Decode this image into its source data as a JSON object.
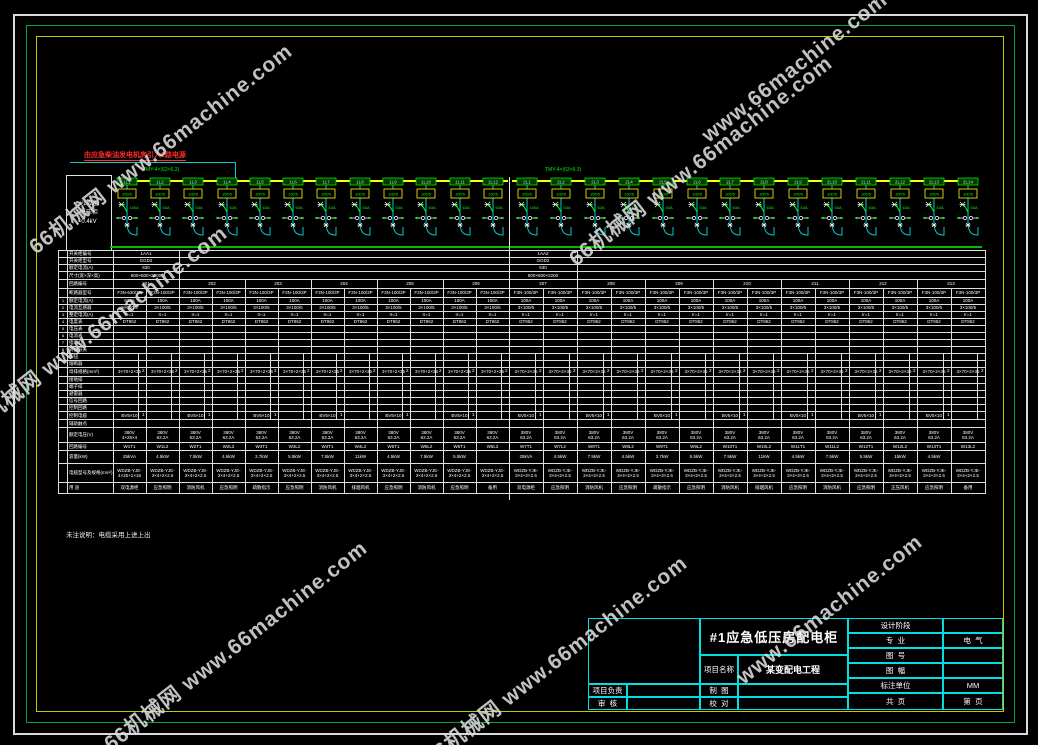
{
  "colors": {
    "frame_white": "#d9d9d9",
    "frame_green": "#00a53c",
    "frame_yellow": "#c8c800",
    "bus_yellow": "#ffff00",
    "cad_green": "#00ff00",
    "cad_cyan": "#00cccc",
    "grid_white": "#dedede",
    "note_red": "#ff2a2a",
    "titleblock_cyan": "#00e0e0"
  },
  "watermarks": {
    "texts": {
      "full": "66机械网 www.66machine.com",
      "latin": "www.66machine.com"
    },
    "items": [
      {
        "x": 160,
        "y": 148,
        "t": "full"
      },
      {
        "x": 795,
        "y": 68,
        "t": "latin"
      },
      {
        "x": 700,
        "y": 160,
        "t": "full"
      },
      {
        "x": 95,
        "y": 330,
        "t": "full"
      },
      {
        "x": 235,
        "y": 645,
        "t": "full"
      },
      {
        "x": 555,
        "y": 660,
        "t": "full"
      },
      {
        "x": 830,
        "y": 610,
        "t": "latin"
      }
    ]
  },
  "notes": {
    "incoming": "由应急柴油发电机房引入2路电源",
    "bus_spec_left": "TMY-4×(63×6.3)",
    "bus_spec_right": "TMY-4×(63×6.3)",
    "bottom": "未注说明：电缆采用上进上出"
  },
  "diagram": {
    "info": [
      "#1应急",
      "低压柜",
      "0.4kV"
    ],
    "feeders": [
      {
        "id": "1L1",
        "ct": "200/5",
        "amp": "100A"
      },
      {
        "id": "1L2",
        "ct": "100/5",
        "amp": "63A"
      },
      {
        "id": "1L3",
        "ct": "100/5",
        "amp": "63A"
      },
      {
        "id": "1L4",
        "ct": "100/5",
        "amp": "63A"
      },
      {
        "id": "1L5",
        "ct": "100/5",
        "amp": "63A"
      },
      {
        "id": "1L6",
        "ct": "100/5",
        "amp": "63A"
      },
      {
        "id": "1L7",
        "ct": "100/5",
        "amp": "63A"
      },
      {
        "id": "1L8",
        "ct": "100/5",
        "amp": "63A"
      },
      {
        "id": "1L9",
        "ct": "100/5",
        "amp": "63A"
      },
      {
        "id": "1L10",
        "ct": "100/5",
        "amp": "63A"
      },
      {
        "id": "1L11",
        "ct": "100/5",
        "amp": "63A"
      },
      {
        "id": "1L12",
        "ct": "100/5",
        "amp": "63A"
      },
      {
        "id": "2L1",
        "ct": "200/5",
        "amp": "100A"
      },
      {
        "id": "2L2",
        "ct": "100/5",
        "amp": "63A"
      },
      {
        "id": "2L3",
        "ct": "100/5",
        "amp": "63A"
      },
      {
        "id": "2L4",
        "ct": "100/5",
        "amp": "63A"
      },
      {
        "id": "2L5",
        "ct": "100/5",
        "amp": "63A"
      },
      {
        "id": "2L6",
        "ct": "100/5",
        "amp": "63A"
      },
      {
        "id": "2L7",
        "ct": "100/5",
        "amp": "63A"
      },
      {
        "id": "2L8",
        "ct": "100/5",
        "amp": "63A"
      },
      {
        "id": "2L9",
        "ct": "100/5",
        "amp": "63A"
      },
      {
        "id": "2L10",
        "ct": "100/5",
        "amp": "63A"
      },
      {
        "id": "2L11",
        "ct": "100/5",
        "amp": "63A"
      },
      {
        "id": "2L12",
        "ct": "100/5",
        "amp": "63A"
      },
      {
        "id": "2L13",
        "ct": "100/5",
        "amp": "63A"
      },
      {
        "id": "2L14",
        "ct": "100/5",
        "amp": "63A"
      }
    ]
  },
  "table": {
    "rows": [
      {
        "h": 7,
        "label": "开关柜编号",
        "type": "half",
        "l": "1AA1",
        "r": "1AA2"
      },
      {
        "h": 7,
        "label": "开关柜型号",
        "type": "half",
        "l": "GGD2",
        "r": "GGD2"
      },
      {
        "h": 7,
        "label": "额定电流(A)",
        "type": "half",
        "l": "630",
        "r": "630"
      },
      {
        "h": 8,
        "label": "尺寸(宽×深×高)",
        "type": "half",
        "l": "800×600×2200",
        "r": "800×600×2200"
      },
      {
        "h": 9,
        "label": "回路编号",
        "type": "groups",
        "values": [
          "201",
          "202",
          "203",
          "204",
          "205",
          "206",
          "207",
          "208",
          "209",
          "210",
          "211",
          "212",
          "213"
        ]
      },
      {
        "h": 9,
        "label": "断路器型号",
        "type": "cells",
        "fill": "F3N-100/3P",
        "first": "F3N-630/3P"
      },
      {
        "h": 7,
        "n": "1",
        "label": "额定电流(A)",
        "type": "cells",
        "fill": "100A",
        "first": "630A"
      },
      {
        "h": 7,
        "n": "2",
        "label": "电流互感器",
        "type": "cells",
        "fill": "3×100/5",
        "first": "3×600/5"
      },
      {
        "h": 7,
        "n": "3",
        "label": "整定电流(A)",
        "type": "cells",
        "fill": "Ir=1",
        "first": "Ir=1"
      },
      {
        "h": 7,
        "n": "4",
        "label": "电度表",
        "type": "cells",
        "fill": "DT862",
        "first": "DT862"
      },
      {
        "h": 7,
        "n": "5",
        "label": "电压表",
        "type": "empty"
      },
      {
        "h": 7,
        "n": "6",
        "label": "电流表",
        "type": "empty"
      },
      {
        "h": 7,
        "n": "7",
        "label": "指示灯",
        "type": "empty"
      },
      {
        "h": 7,
        "n": "8",
        "label": "转换开关",
        "type": "empty"
      },
      {
        "h": 7,
        "label": "按钮",
        "type": "empty",
        "split": true
      },
      {
        "h": 7,
        "label": "熔断器",
        "type": "empty",
        "split": true
      },
      {
        "h": 9,
        "label": "母排规格(mm²)",
        "type": "cells",
        "fill": "3×70+2×35",
        "first": "3×70+2×35",
        "sub": "2",
        "split": true
      },
      {
        "h": 7,
        "label": "接地排",
        "type": "empty",
        "split": true
      },
      {
        "h": 7,
        "label": "端子排",
        "type": "empty",
        "split": true
      },
      {
        "h": 7,
        "label": "避雷器",
        "type": "empty",
        "split": true
      },
      {
        "h": 7,
        "label": "信号回路",
        "type": "empty",
        "split": true
      },
      {
        "h": 7,
        "label": "控制回路",
        "type": "empty",
        "split": true
      },
      {
        "h": 8,
        "label": "控制电缆",
        "type": "cells",
        "fill": "BV5×10",
        "sub": "1",
        "alt": true,
        "split": true
      },
      {
        "h": 8,
        "label": "辅助触点",
        "type": "empty"
      },
      {
        "h": 15,
        "label": "额定电压(V)",
        "type": "cells",
        "fill": "380V\n63.2A",
        "first": "380V\n4×25×4"
      },
      {
        "h": 8,
        "label": "回路编号",
        "type": "cells",
        "cells": [
          "W1T1",
          "W1L2",
          "W2T1",
          "W2L2",
          "W3T1",
          "W3L2",
          "W4T1",
          "W4L2",
          "W5T1",
          "W5L2",
          "W6T1",
          "W6L2",
          "W7T1",
          "W7L2",
          "W8T1",
          "W8L2",
          "W9T1",
          "W9L2",
          "W10T1",
          "W10L2",
          "W11T1",
          "W11L2",
          "W12T1",
          "W12L2",
          "W13T1",
          "W13L2"
        ]
      },
      {
        "h": 13,
        "label": "容量(kW)",
        "type": "cells",
        "cells": [
          "25kVA",
          "4.5kW",
          "7.5kW",
          "4.5kW",
          "3.7kW",
          "5.5kW",
          "7.5kW",
          "11kW",
          "4.5kW",
          "7.5kW",
          "5.5kW",
          "",
          "25kVA",
          "4.5kW",
          "7.5kW",
          "4.5kW",
          "3.7kW",
          "5.5kW",
          "7.5kW",
          "11kW",
          "4.5kW",
          "7.5kW",
          "5.5kW",
          "15kW",
          "4.5kW",
          ""
        ]
      },
      {
        "h": 19,
        "label": "电缆型号及规格(mm²)",
        "type": "cells",
        "fill": "WDZB-YJE-\n3×4+2×2.5",
        "first": "WDZB-YJE-\n4×25+1×16"
      },
      {
        "h": 11,
        "label": "用 途",
        "type": "cells",
        "cells": [
          "双电源柜",
          "应急照明",
          "消防风机",
          "应急照明",
          "疏散指示",
          "应急照明",
          "消防风机",
          "排烟风机",
          "应急照明",
          "消防风机",
          "应急照明",
          "备用",
          "双电源柜",
          "应急照明",
          "消防风机",
          "应急照明",
          "疏散指示",
          "应急照明",
          "消防风机",
          "排烟风机",
          "应急照明",
          "消防风机",
          "应急照明",
          "正压风机",
          "应急照明",
          "备用"
        ]
      }
    ]
  },
  "titleblock": {
    "title": "#1应急低压房配电柜",
    "project_label": "项目名称",
    "project_value": "某变配电工程",
    "left_rows": [
      {
        "label": "项目负责",
        "value": ""
      },
      {
        "label": "审  核",
        "value": ""
      }
    ],
    "mid_rows": [
      {
        "label": "制  图",
        "value": ""
      },
      {
        "label": "校  对",
        "value": ""
      }
    ],
    "right_rows": [
      {
        "label": "设计阶段",
        "value": ""
      },
      {
        "label": "专  业",
        "value": "电  气"
      },
      {
        "label": "图  号",
        "value": ""
      },
      {
        "label": "图  幅",
        "value": ""
      },
      {
        "label": "标注单位",
        "value": "MM"
      },
      {
        "label": "共  页",
        "value": "第  页"
      }
    ]
  }
}
